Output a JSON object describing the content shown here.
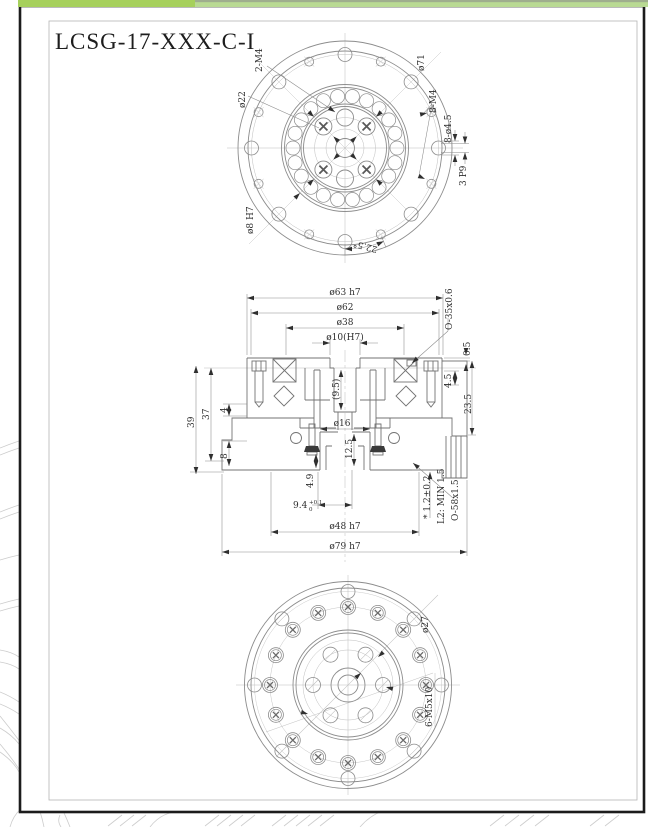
{
  "title": "LCSG-17-XXX-C-I",
  "colors": {
    "bar_left": "#a6d05c",
    "bar_right": "#b9da93",
    "bar_right_top": "#9fae8e",
    "page_border": "#1c1c1c",
    "frame": "#b5b5b5"
  },
  "top_view": {
    "label_2m4": "2-M4",
    "label_dia22": "ø22",
    "label_dia71": "ø71",
    "label_8m4": "8-M4",
    "label_8dia45": "8-ø4.5",
    "label_keyway": "3 P9",
    "label_dia8h7": "ø8 H7",
    "label_angle": "22.5°"
  },
  "section_view": {
    "dia63": "ø63 h7",
    "dia62": "ø62",
    "dia38": "ø38",
    "dia10": "ø10(H7)",
    "oring_top": "O-35x0.6",
    "dim_05": "0.5",
    "dim_45": "4.5",
    "dim_235": "23.5",
    "dim_39": "39",
    "dim_37": "37",
    "dim_4": "4",
    "dim_8": "8",
    "dim_95": "(9.5)",
    "dia16": "ø16",
    "dim_125": "12.5",
    "dim_49": "4.9",
    "dim_94": "9.4",
    "dim_94_tol_upper": "+0.1",
    "dim_94_tol_lower": "0",
    "dim_12": "* 1.2±0.2",
    "dim_l2": "L2: MIN 1.5",
    "oring_bottom": "O-58x1.5",
    "dia48": "ø48 h7",
    "dia79": "ø79 h7"
  },
  "bottom_view": {
    "label_dia27": "ø27",
    "label_6m5": "6-M5x10"
  }
}
